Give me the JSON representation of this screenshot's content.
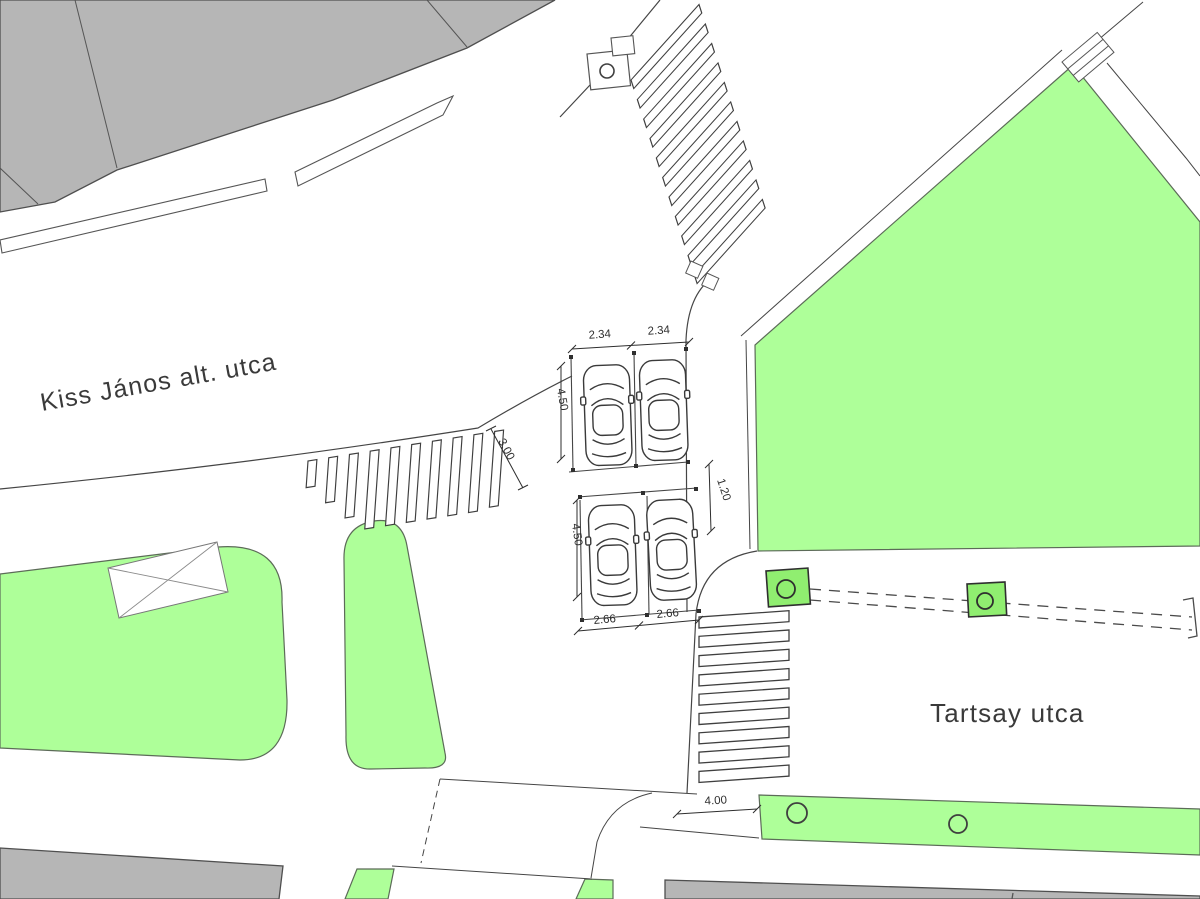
{
  "plan": {
    "title": "intersection-site-plan",
    "streets": [
      {
        "id": "kiss-janos-alt-utca",
        "label": "Kiss János alt. utca"
      },
      {
        "id": "tartsay-utca",
        "label": "Tartsay utca"
      }
    ],
    "dimensions": [
      {
        "id": "parking-stall-width-top-left",
        "value": "2.34"
      },
      {
        "id": "parking-stall-width-top-right",
        "value": "2.34"
      },
      {
        "id": "parking-stall-depth-top",
        "value": "4.50"
      },
      {
        "id": "crosswalk-width",
        "value": "3.00"
      },
      {
        "id": "parking-stall-depth-bottom",
        "value": "4.50"
      },
      {
        "id": "sidewalk-width",
        "value": "1.20"
      },
      {
        "id": "parking-stall-width-bottom-left",
        "value": "2.66"
      },
      {
        "id": "parking-stall-width-bottom-right",
        "value": "2.66"
      },
      {
        "id": "crossing-width",
        "value": "4.00"
      }
    ],
    "colors": {
      "green": "#aeff99",
      "tree_square_green": "#90ee70",
      "building_gray": "#b6b6b6",
      "line": "#454545",
      "text": "#3a3a3a"
    }
  }
}
